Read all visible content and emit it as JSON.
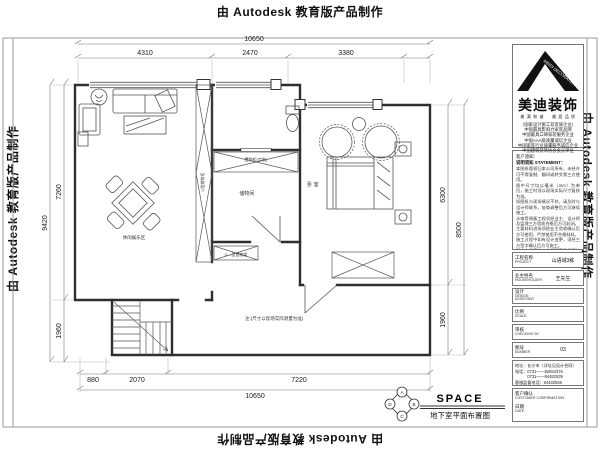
{
  "colors": {
    "ink": "#2e2e2e",
    "dim": "#444444"
  },
  "stamps": {
    "autodesk": "由 Autodesk 教育版产品制作"
  },
  "plan": {
    "dims": {
      "top_total": "10650",
      "top_seg1": "4310",
      "top_seg2": "2470",
      "top_seg3": "3380",
      "left_inner": "7260",
      "left_total": "9420",
      "left_lower": "1960",
      "right_inner": "6300",
      "right_total": "8500",
      "right_lower": "1960",
      "bottom_seg1": "880",
      "bottom_seg2": "2070",
      "bottom_seg3": "7220",
      "bottom_total": "10650"
    },
    "labels": {
      "leisure": "休闲娱乐区",
      "storage_strip": "U型储物柜",
      "custom_cabinet": "置物柜(定制)",
      "storage_room": "储物间",
      "rack": "U—型置物架",
      "bedroom": "卧 室",
      "note": "注:(尺寸以现场实际测量为准)"
    },
    "drawing_title": {
      "space": "SPACE",
      "caption": "地下室平面布置图"
    },
    "compass": {
      "top": "A",
      "right": "B",
      "bottom": "C",
      "left": "D"
    }
  },
  "titleblock": {
    "logo": {
      "brand": "美迪装饰",
      "roof_text": "MEIDI DECORATION",
      "tagline": "美 满 和 谐 　 美 居 品 质",
      "certs": [
        "（国家设计施工双资质企业）",
        "中国最具影响力家装品牌",
        "中国最具口碑家装服务企业",
        "中国AAA级质量诚信企业",
        "中国家装行业质量服务诚信企业",
        "中国建筑装饰协会会员单位"
      ]
    },
    "statement": {
      "heading1": "客户须知：",
      "heading2": "说明须知 STATEMENT：",
      "lines": [
        "本图纸版权归本公司所有，未经许可不得复制、翻印或转交第三方使用。",
        "图中尺寸均以毫米（mm）为单位，施工时须以现场实际尺寸复核为准。",
        "如图纸与现场情况不符，请及时与设计师联系，协商调整后方可继续施工。",
        "水电等隐蔽工程须经业主、设计师及监理三方验收合格后方可封闭。",
        "主要材料进场须经业主验收确认后方可使用，严禁使用不合格材料。",
        "施工过程中如有设计变更，须经三方签字确认后方可施工。",
        "图中未尽事宜，参照国家现行建筑装饰装修工程施工及验收规范执行。"
      ]
    },
    "rows": [
      {
        "cn": "工程名称",
        "en": "PROJECT",
        "value": "山语城3栋"
      },
      {
        "cn": "业主姓名",
        "en": "HOUSEHOLDER",
        "value": "王先生"
      },
      {
        "cn": "设计",
        "en": "DESIGN ASSISTANT",
        "value": ""
      },
      {
        "cn": "比例",
        "en": "SCALE",
        "value": ""
      },
      {
        "cn": "审核",
        "en": "CHECKING BY",
        "value": ""
      },
      {
        "cn": "图号",
        "en": "NUMBER",
        "value": "03"
      }
    ],
    "contact": {
      "line1": "地址：长沙市（详址见设计合同）",
      "line2": "电话：0731——82553376",
      "line3": "　　　0731——84482539",
      "line4": "客服监督电话：84482556"
    },
    "confirm": {
      "cn": "客户确认",
      "en": "CUSTOMER CONFIRMATION",
      "date_cn": "日期",
      "date_en": "DATE"
    }
  }
}
